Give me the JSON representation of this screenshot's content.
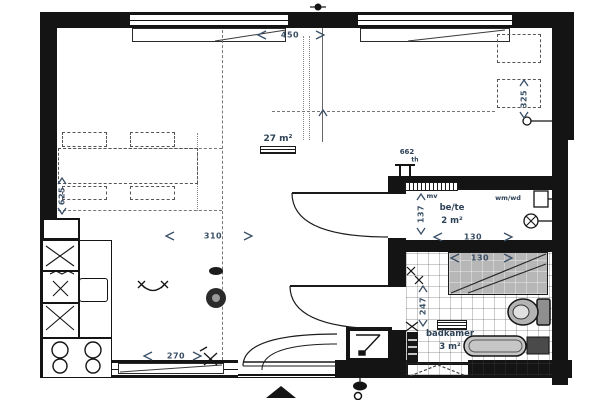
{
  "rooms": {
    "living": {
      "area": "27 m²"
    },
    "storage": {
      "name": "be/te",
      "area": "2 m²",
      "washer_label": "wm/wd",
      "vent_label": "mv"
    },
    "bathroom": {
      "name": "badkamer",
      "area": "3 m²"
    }
  },
  "dimensions": {
    "top_width": "450",
    "living_width": "310",
    "bottom_width": "270",
    "left_depth": "625",
    "right_depth": "325",
    "storage_width": "130",
    "storage_depth": "137",
    "shower_width": "130",
    "bathroom_depth": "247"
  },
  "annotations": {
    "electrical_code": "662",
    "thermostat": "th"
  },
  "colors": {
    "wall": "#141414",
    "dimension_text": "#3a4f66",
    "label_text": "#2e4257",
    "shower_fill": "#b7b7b7",
    "fixture_fill": "#c6c6c6"
  }
}
